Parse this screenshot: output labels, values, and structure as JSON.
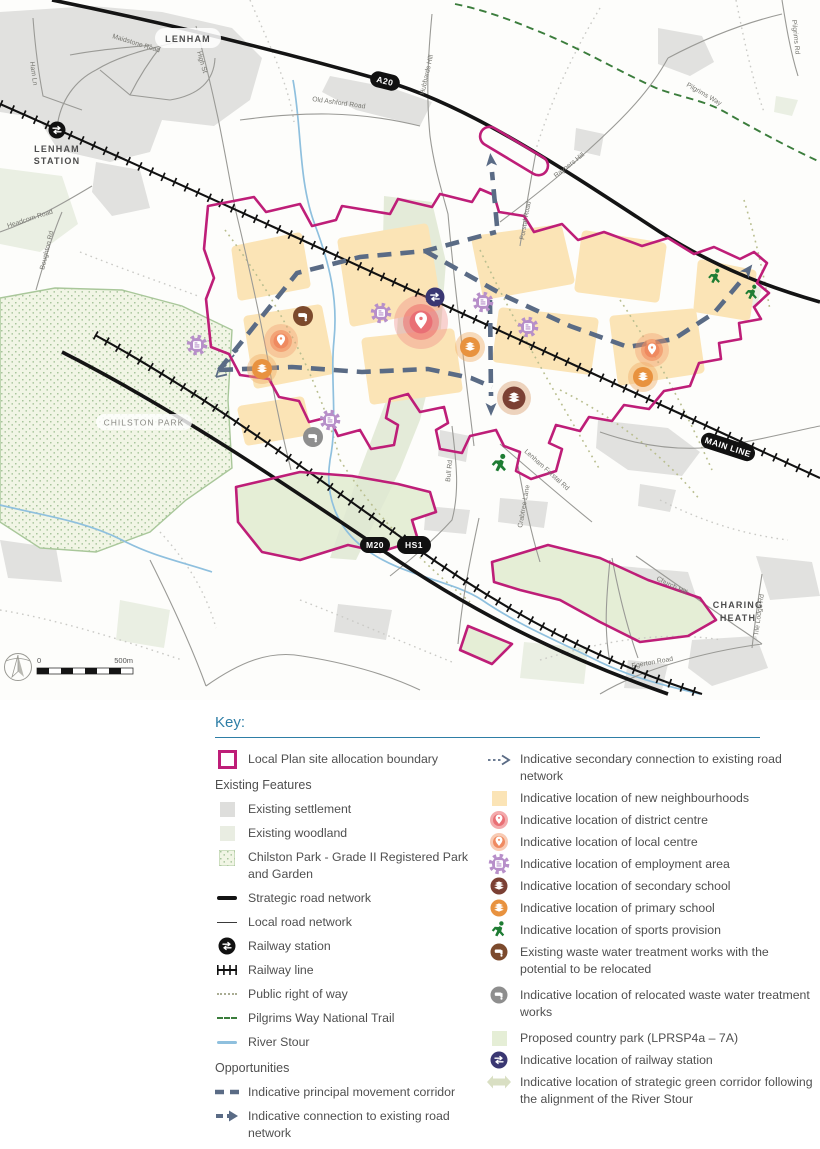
{
  "map": {
    "badges": {
      "a20": "A20",
      "m20": "M20",
      "hs1": "HS1",
      "main_line": "MAIN LINE"
    },
    "places": {
      "lenham": "LENHAM",
      "lenham_station_1": "LENHAM",
      "lenham_station_2": "STATION",
      "chilston_park": "CHILSTON PARK",
      "charing_heath_1": "CHARING",
      "charing_heath_2": "HEATH"
    },
    "roads": {
      "maidstone_road": "Maidstone Road",
      "ham_ln": "Ham Ln",
      "high_st": "High St",
      "old_ashford_road": "Old Ashford Road",
      "hubbards_hill": "Hubbards Hill",
      "headcorn_road": "Headcorn Road",
      "boughton_rd": "Boughton Rd",
      "pilgrims_way": "Pilgrims Way",
      "pilgrims_rd": "Pilgrims Rd",
      "rayners_hill": "Rayners Hill",
      "forstal_road": "Forstal Road",
      "bull_rd": "Bull Rd",
      "lenham_forstal_rd": "Lenham Forstal Rd",
      "crabtree_lane": "Crabtree Lane",
      "church_hill": "Church Hill",
      "egerton_road": "Egerton Road",
      "tile_lodge_rd": "Tile Lodge Rd"
    },
    "scale_bar": {
      "start": "0",
      "end": "500m"
    }
  },
  "key": {
    "title": "Key:",
    "boundary_label": "Local Plan site allocation boundary",
    "existing_header": "Existing Features",
    "opportunities_header": "Opportunities",
    "existing_items": [
      "Existing settlement",
      "Existing woodland",
      "Chilston Park - Grade II Registered Park and Garden",
      "Strategic road network",
      "Local road network",
      "Railway station",
      "Railway line",
      "Public right of way",
      "Pilgrims Way National Trail",
      "River Stour"
    ],
    "opportunity_items_left": [
      "Indicative principal movement corridor",
      "Indicative connection to existing road network"
    ],
    "right_items": [
      "Indicative secondary connection to existing road network",
      "Indicative location of new neighbourhoods",
      "Indicative location of district centre",
      "Indicative location of local centre",
      "Indicative location of employment area",
      "Indicative location of secondary school",
      "Indicative location of primary school",
      "Indicative location of sports provision",
      "Existing waste water treatment works with the potential to be relocated",
      "Indicative location of relocated waste water treatment works",
      "Proposed country park (LPRSP4a – 7A)",
      "Indicative location of railway station",
      "Indicative location of strategic green corridor following the alignment of the River Stour"
    ]
  },
  "colors": {
    "boundary": "#BE1E78",
    "neighbourhood": "#FBE4B6",
    "corridor": "#5A6B85",
    "pilgrims_way": "#3B7D3C",
    "river": "#8FC0DE",
    "employment": "#B78FC9",
    "district_centre": "#E96F75",
    "local_centre": "#EF8A60",
    "secondary_school": "#7B4034",
    "primary_school": "#E8923F",
    "sports": "#1E7C33",
    "waste_existing": "#7C4A2D",
    "waste_relocated": "#8E8E8E",
    "railway_station": "#3A3772",
    "green_corridor": "#D9DFC3",
    "key_accent": "#2E7EA6"
  }
}
